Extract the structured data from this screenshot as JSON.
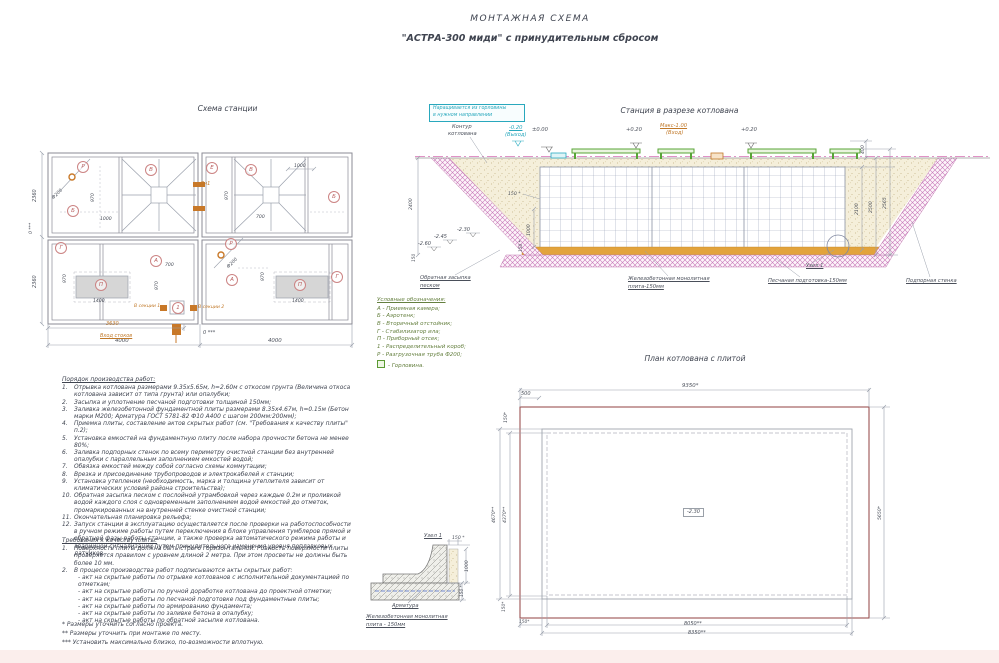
{
  "title": {
    "line1": "МОНТАЖНАЯ СХЕМА",
    "line2": "\"АСТРА-300 миди\" с принудительным сбросом"
  },
  "sections": {
    "plan_title": "Схема станции",
    "cross_title": "Станция в разрезе котлована",
    "pit_title": "План котлована с плитой"
  },
  "legend": {
    "title": "Условные обозначения:",
    "items": [
      "А - Приемная камера;",
      "Б - Аэротенк;",
      "В - Вторичный отстойник;",
      "Г - Стабилизатор ила;",
      "П - Приборный отсек;",
      "1 - Распределительный короб;",
      "Р - Разгрузочная труба Ф200;"
    ],
    "neck": "- Горловина."
  },
  "work_order": {
    "title": "Порядок производства работ:",
    "items": [
      {
        "n": "1.",
        "t": "Отрывка котлована размерами 9.35х5.65м, h=2.60м с откосом грунта (Величина откоса котлована зависит от типа грунта) или опалубки;"
      },
      {
        "n": "2.",
        "t": "Засыпка и уплотнение песчаной подготовки толщиной 150мм;"
      },
      {
        "n": "3.",
        "t": "Заливка железобетонной фундаментной плиты размерами 8.35х4.67м, h=0.15м (Бетон марки М200; Арматура ГОСТ 5781-82 Ф10 А400 с шагом 200мм:200мм);"
      },
      {
        "n": "4.",
        "t": "Приемка плиты, составление актов скрытых работ (см. \"Требования к качеству плиты\" п.2);"
      },
      {
        "n": "5.",
        "t": "Установка емкостей на фундаментную плиту после набора прочности бетона не менее 80%;"
      },
      {
        "n": "6.",
        "t": "Заливка подпорных стенок по всему периметру очистной станции без внутренней опалубки с параллельным заполнением емкостей водой;"
      },
      {
        "n": "7.",
        "t": "Обвязка емкостей между собой согласно схемы коммутации;"
      },
      {
        "n": "8.",
        "t": "Врезка и присоединение трубопроводов и электрокабелей к станции;"
      },
      {
        "n": "9.",
        "t": "Установка утепления (необходимость, марка и толщина утеплителя зависит от климатических условий района строительства);"
      },
      {
        "n": "10.",
        "t": "Обратная засыпка песком с послойной утрамбовкой через каждые 0.2м и проливкой водой каждого слоя с одновременным заполнением водой емкостей до отметок, промаркированных на внутренней стенке очистной станции;"
      },
      {
        "n": "11.",
        "t": "Окончательная планировка рельефа;"
      },
      {
        "n": "12.",
        "t": "Запуск станции в эксплуатацию осуществляется после проверки на работоспособности в ручном режиме работы путем переключения в блоке управления тумблеров прямой и обратной фазы работы станции, а также проверка автоматического режима работы и аварийной сигнализации путем принудительного изменения уровня поплавковых датчиков."
      }
    ]
  },
  "quality": {
    "title": "Требования к качеству плиты:",
    "items": [
      {
        "n": "1.",
        "t": "Поверхность плиты должна быть строго горизонтальной. Ровность поверхности плиты проверяется правилом с уровнем длиной 2 метра. При этом просветы не должны быть более 10 мм."
      },
      {
        "n": "2.",
        "t": "В процессе производства работ подписываются акты скрытых работ:"
      }
    ],
    "acts": [
      "- акт на скрытые работы по отрывке котлованов с исполнительной документацией по отметкам;",
      "- акт на скрытые работы по ручной доработке котлована до проектной отметки;",
      "- акт на скрытые работы по песчаной подготовке под фундаментные плиты;",
      "- акт на скрытые работы по армированию фундамента;",
      "- акт на скрытые работы по заливке бетона в опалубку;",
      "- акт на скрытые работы по обратной засыпке котлована."
    ]
  },
  "footnotes": [
    "* Размеры уточнить согласно проекта.",
    "** Размеры уточнить при монтаже по месту.",
    "*** Установить максимально близко, по-возможности вплотную."
  ],
  "colors": {
    "accent_orange": "#c07828",
    "accent_cyan": "#29a8bd",
    "accent_green": "#5a9a32",
    "accent_red": "#b85c5c",
    "hatch_pink": "#c878b8",
    "sand_layer": "#e2a33c"
  },
  "plan_circles": [
    {
      "t": "Р",
      "x": 82,
      "y": 166
    },
    {
      "t": "Б",
      "x": 72,
      "y": 210
    },
    {
      "t": "В",
      "x": 150,
      "y": 169
    },
    {
      "t": "Е",
      "x": 211,
      "y": 167
    },
    {
      "t": "В",
      "x": 250,
      "y": 169
    },
    {
      "t": "Б",
      "x": 333,
      "y": 196
    },
    {
      "t": "Г",
      "x": 60,
      "y": 247
    },
    {
      "t": "А",
      "x": 155,
      "y": 260
    },
    {
      "t": "П",
      "x": 100,
      "y": 284
    },
    {
      "t": "Р",
      "x": 230,
      "y": 243
    },
    {
      "t": "А",
      "x": 231,
      "y": 279
    },
    {
      "t": "П",
      "x": 299,
      "y": 284
    },
    {
      "t": "Г",
      "x": 336,
      "y": 276
    },
    {
      "t": "1",
      "x": 177,
      "y": 307
    }
  ],
  "annotations": [
    {
      "t": "2360",
      "x": 33,
      "y": 202,
      "r": -90,
      "fs": 5
    },
    {
      "t": "2360",
      "x": 33,
      "y": 288,
      "r": -90,
      "fs": 5
    },
    {
      "t": "0 ***",
      "x": 30,
      "y": 234,
      "r": -90,
      "fs": 4.6
    },
    {
      "t": "4000",
      "x": 115,
      "y": 339,
      "fs": 5.4
    },
    {
      "t": "4000",
      "x": 268,
      "y": 339,
      "fs": 5.4
    },
    {
      "t": "3630",
      "x": 106,
      "y": 322,
      "c": "orange",
      "fs": 5
    },
    {
      "t": "Вход стоков",
      "x": 100,
      "y": 334,
      "c": "orange",
      "u": 1,
      "fs": 5
    },
    {
      "t": "0 ***",
      "x": 203,
      "y": 331,
      "fs": 5
    },
    {
      "t": "970",
      "x": 92,
      "y": 202,
      "r": -90,
      "fs": 4.6
    },
    {
      "t": "1000",
      "x": 100,
      "y": 218,
      "fs": 4.6
    },
    {
      "t": "Ф200",
      "x": 52,
      "y": 198,
      "r": -45,
      "fs": 4.6
    },
    {
      "t": "970",
      "x": 226,
      "y": 200,
      "r": -90,
      "fs": 4.6
    },
    {
      "t": "700",
      "x": 256,
      "y": 216,
      "fs": 4.6
    },
    {
      "t": "1000",
      "x": 294,
      "y": 165,
      "fs": 4.6
    },
    {
      "t": "Дн1",
      "x": 200,
      "y": 182,
      "c": "orange",
      "fs": 5
    },
    {
      "t": "970",
      "x": 64,
      "y": 283,
      "r": -90,
      "fs": 4.6
    },
    {
      "t": "1400",
      "x": 93,
      "y": 300,
      "fs": 4.6
    },
    {
      "t": "700",
      "x": 165,
      "y": 264,
      "fs": 4.6
    },
    {
      "t": "970",
      "x": 156,
      "y": 290,
      "r": -90,
      "fs": 4.6
    },
    {
      "t": "1400",
      "x": 292,
      "y": 300,
      "fs": 4.6
    },
    {
      "t": "970",
      "x": 262,
      "y": 281,
      "r": -90,
      "fs": 4.6
    },
    {
      "t": "Ф200",
      "x": 227,
      "y": 267,
      "r": -45,
      "fs": 4.6
    },
    {
      "t": "В секции 1",
      "x": 134,
      "y": 305,
      "c": "orange",
      "fs": 4.6
    },
    {
      "t": "В секции 2",
      "x": 198,
      "y": 306,
      "c": "orange",
      "fs": 4.6
    },
    {
      "box": true,
      "x": 429,
      "y": 104,
      "w": 94,
      "h": 16,
      "c": "cyan"
    },
    {
      "t": "Наращивается из горловины",
      "x": 433,
      "y": 107,
      "c": "cyan",
      "fs": 4.8
    },
    {
      "t": "в нужном направлении",
      "x": 433,
      "y": 114,
      "c": "cyan",
      "fs": 4.8
    },
    {
      "t": "Контур",
      "x": 452,
      "y": 125,
      "fs": 5.2
    },
    {
      "t": "котлована",
      "x": 448,
      "y": 132,
      "fs": 5.2
    },
    {
      "t": "-0.20",
      "x": 509,
      "y": 126,
      "c": "cyan",
      "u": 1,
      "fs": 5.2
    },
    {
      "t": "(Выход)",
      "x": 505,
      "y": 133,
      "c": "cyan",
      "fs": 5.2
    },
    {
      "t": "±0.00",
      "x": 532,
      "y": 128,
      "fs": 5.2
    },
    {
      "t": "+0.20",
      "x": 626,
      "y": 128,
      "fs": 5.2
    },
    {
      "t": "Макс-1.00",
      "x": 660,
      "y": 124,
      "c": "orange",
      "u": 1,
      "fs": 5.2
    },
    {
      "t": "(Вход)",
      "x": 666,
      "y": 131,
      "c": "orange",
      "fs": 5.2
    },
    {
      "t": "+0.20",
      "x": 741,
      "y": 128,
      "fs": 5.2
    },
    {
      "t": "400",
      "x": 862,
      "y": 154,
      "r": -90,
      "fs": 4.6
    },
    {
      "t": "2100",
      "x": 856,
      "y": 215,
      "r": -90,
      "fs": 4.6
    },
    {
      "t": "2500",
      "x": 870,
      "y": 213,
      "r": -90,
      "fs": 4.6
    },
    {
      "t": "2565",
      "x": 884,
      "y": 209,
      "r": -90,
      "fs": 4.6
    },
    {
      "t": "2400",
      "x": 410,
      "y": 210,
      "r": -90,
      "fs": 4.6
    },
    {
      "t": "150 *",
      "x": 508,
      "y": 193,
      "fs": 4.6
    },
    {
      "t": "1000",
      "x": 528,
      "y": 236,
      "r": -90,
      "fs": 4.6
    },
    {
      "t": "150 *",
      "x": 520,
      "y": 252,
      "r": -90,
      "fs": 4.3
    },
    {
      "t": "-2.30",
      "x": 457,
      "y": 228,
      "fs": 5
    },
    {
      "t": "-2.45",
      "x": 434,
      "y": 235,
      "fs": 5
    },
    {
      "t": "-2.60",
      "x": 418,
      "y": 242,
      "fs": 5
    },
    {
      "t": "150",
      "x": 413,
      "y": 262,
      "r": -90,
      "fs": 4.3
    },
    {
      "t": "Обратная засыпка",
      "x": 420,
      "y": 276,
      "u": 1,
      "fs": 5.2
    },
    {
      "t": "песком",
      "x": 420,
      "y": 284,
      "u": 1,
      "fs": 5.2
    },
    {
      "t": "Железобетонная монолитная",
      "x": 628,
      "y": 277,
      "u": 1,
      "fs": 5.2
    },
    {
      "t": "плита-150мм",
      "x": 628,
      "y": 285,
      "u": 1,
      "fs": 5.2
    },
    {
      "t": "Узел 1",
      "x": 806,
      "y": 264,
      "u": 1,
      "fs": 5.2
    },
    {
      "t": "Песчаная подготовка-150мм",
      "x": 768,
      "y": 279,
      "u": 1,
      "fs": 5.2
    },
    {
      "t": "Подпорная стенка",
      "x": 906,
      "y": 279,
      "u": 1,
      "fs": 5.2
    },
    {
      "t": "9350*",
      "x": 682,
      "y": 384,
      "fs": 5.4
    },
    {
      "t": "500",
      "x": 521,
      "y": 392,
      "fs": 5
    },
    {
      "t": "150*",
      "x": 505,
      "y": 423,
      "r": -90,
      "fs": 4.6
    },
    {
      "t": "4670**",
      "x": 493,
      "y": 523,
      "r": -90,
      "fs": 4.6
    },
    {
      "t": "4370**",
      "x": 504,
      "y": 523,
      "r": -90,
      "fs": 4.6
    },
    {
      "t": "5650*",
      "x": 879,
      "y": 520,
      "r": -90,
      "fs": 4.6
    },
    {
      "t": "-2.30",
      "x": 683,
      "y": 508,
      "bx": 1,
      "fs": 5
    },
    {
      "t": "150*",
      "x": 503,
      "y": 612,
      "r": -90,
      "fs": 4.3
    },
    {
      "t": "150*",
      "x": 519,
      "y": 621,
      "fs": 4.3
    },
    {
      "t": "8050**",
      "x": 684,
      "y": 622,
      "fs": 5
    },
    {
      "t": "8350**",
      "x": 688,
      "y": 631,
      "fs": 5
    },
    {
      "t": "Узел 1",
      "x": 424,
      "y": 534,
      "u": 1,
      "fs": 5.4
    },
    {
      "t": "150 *",
      "x": 452,
      "y": 537,
      "fs": 4.6
    },
    {
      "t": "1000",
      "x": 466,
      "y": 572,
      "r": -90,
      "fs": 4.6
    },
    {
      "t": "150 *",
      "x": 461,
      "y": 597,
      "r": -90,
      "fs": 4.3
    },
    {
      "t": "Арматура",
      "x": 392,
      "y": 604,
      "u": 1,
      "fs": 5.2
    },
    {
      "t": "Железобетонная монолитная",
      "x": 366,
      "y": 615,
      "u": 1,
      "fs": 5.2
    },
    {
      "t": "плита - 150мм",
      "x": 366,
      "y": 623,
      "u": 1,
      "fs": 5.2
    }
  ]
}
